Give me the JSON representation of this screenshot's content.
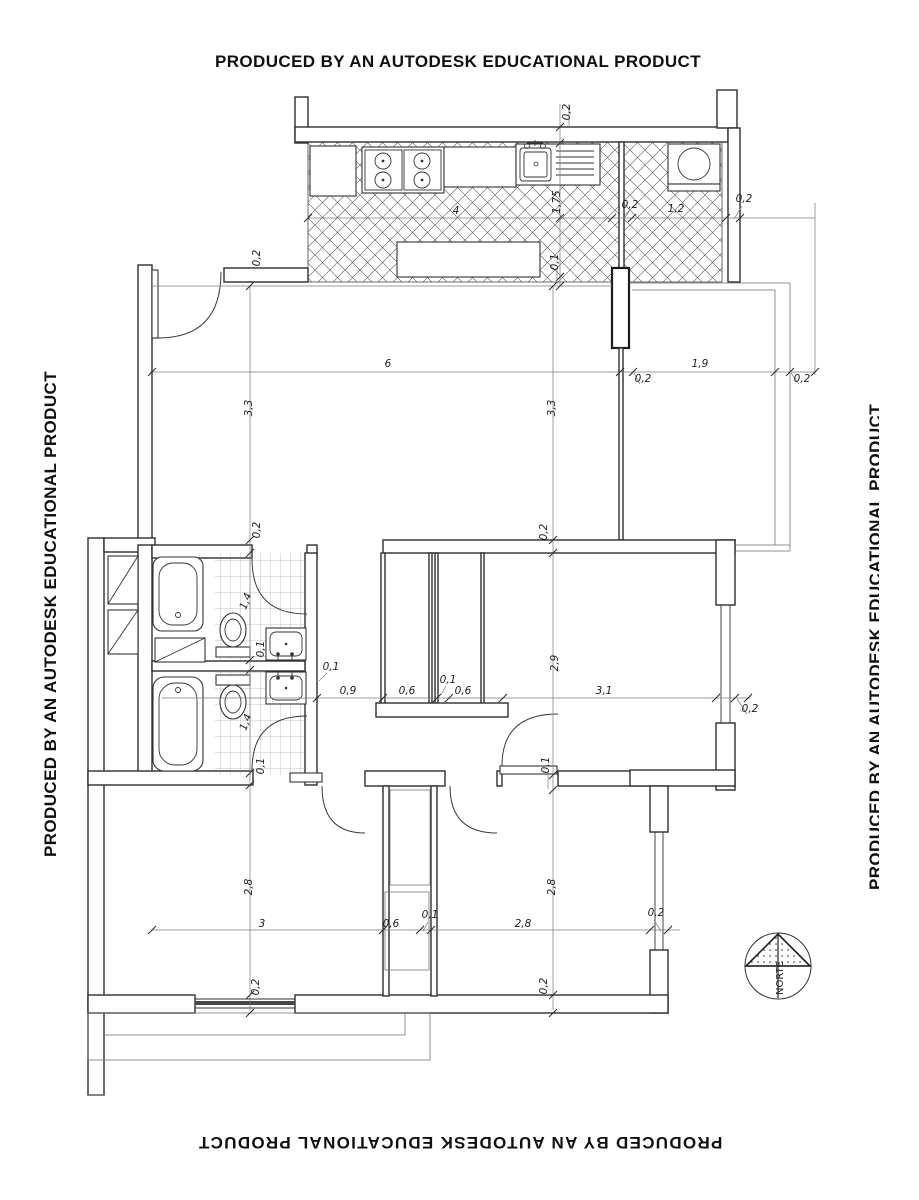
{
  "watermark": {
    "text": "PRODUCED BY AN AUTODESK EDUCATIONAL PRODUCT"
  },
  "compass": {
    "label": "NORTE"
  },
  "dims": {
    "kitchen": [
      "0,2",
      "4",
      "1,75",
      "0,2",
      "1,2",
      "0,2",
      "0,1"
    ],
    "upper": [
      "0,2",
      "6",
      "0,2",
      "1,9",
      "0,2",
      "3,3",
      "3,3"
    ],
    "middle": [
      "0,2",
      "0,2",
      "1,4",
      "0,1",
      "1,4",
      "0,1",
      "0,1",
      "0,9",
      "0,6",
      "0,1",
      "0,6",
      "2,9",
      "3,1",
      "0,2",
      "0,1"
    ],
    "lower": [
      "2,8",
      "2,8",
      "3",
      "0,6",
      "0,1",
      "2,8",
      "0,2",
      "0,2",
      "0,2"
    ]
  }
}
